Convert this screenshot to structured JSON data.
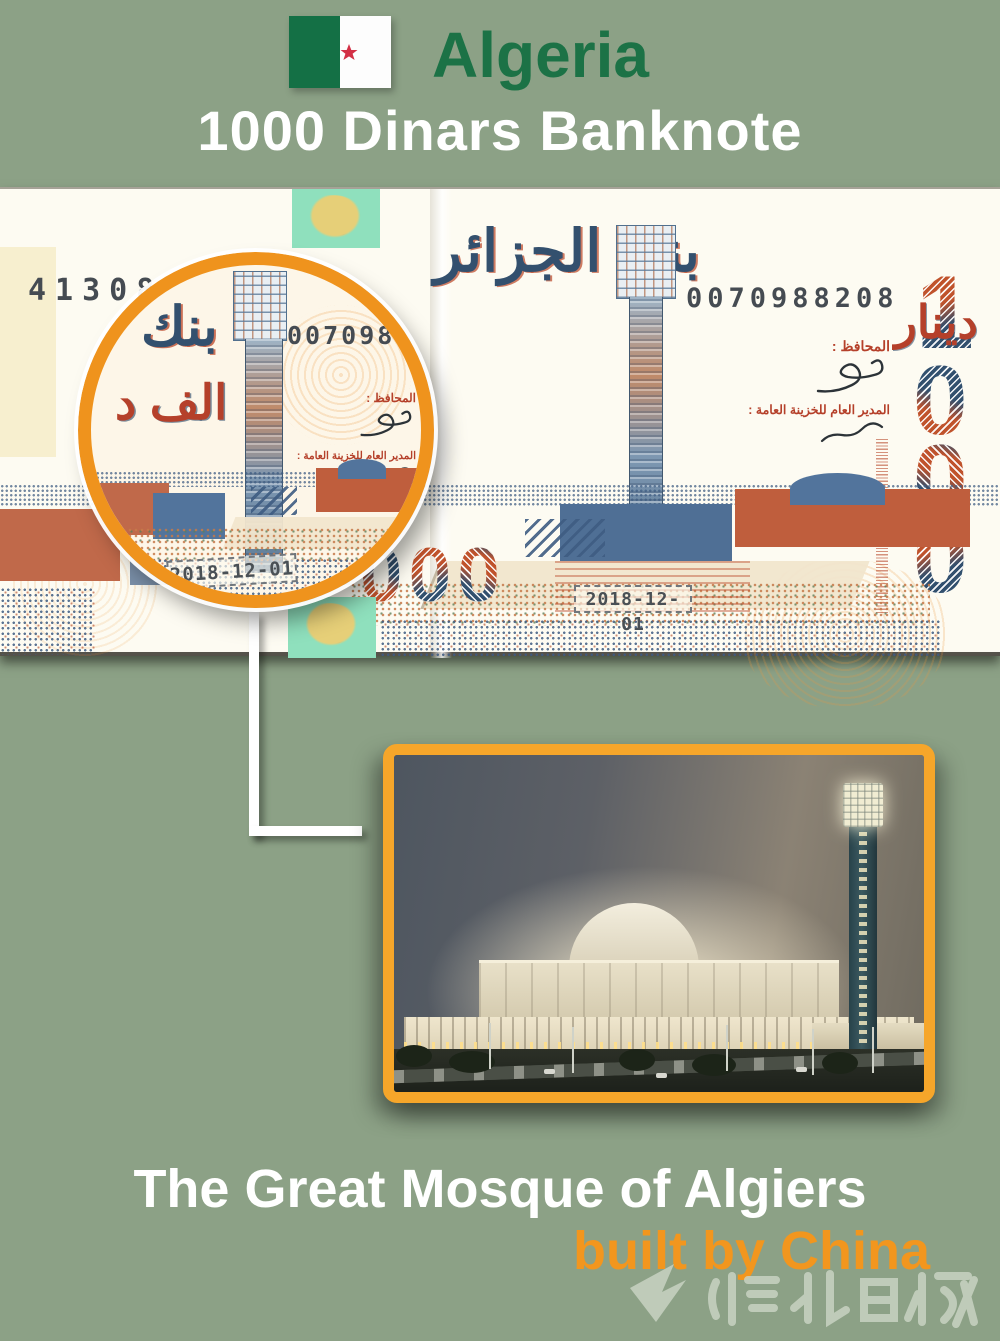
{
  "header": {
    "country": "Algeria",
    "subtitle": "1000 Dinars Banknote",
    "colors": {
      "background": "#8CA186",
      "country_text": "#1C7246",
      "subtitle_text": "#FFFFFF",
      "flag_green": "#147045",
      "flag_red": "#D32F45"
    }
  },
  "banknote": {
    "serial_top_left": "41308",
    "serial_top_right": "0070988208",
    "serial_bottom_left": "05 00",
    "bank_name_arabic": "بنك الجزائر",
    "dinar_fragment_arabic": "دينار",
    "governor_label_arabic": "المحافظ :",
    "treasury_label_arabic": "المدير العام للخزينة العامة :",
    "issue_date": "2018-12-01",
    "denom_digits": [
      "1",
      "0",
      "0",
      "0"
    ]
  },
  "magnifier": {
    "bank_word_arabic": "بنك",
    "thousand_word_arabic": "الف د",
    "serial_fragment": "0070988",
    "governor_label_arabic": "المحافظ :",
    "treasury_label_arabic": "المدير العام للخزينة العامة :",
    "issue_date": "2018-12-01",
    "ring_color": "#EF931D"
  },
  "caption": {
    "line1": "The Great Mosque of Algiers",
    "line2": "built by China",
    "line2_color": "#F2961E"
  },
  "photo": {
    "border_color": "#F6A62A"
  },
  "watermark": {
    "text": "湖北日报"
  }
}
